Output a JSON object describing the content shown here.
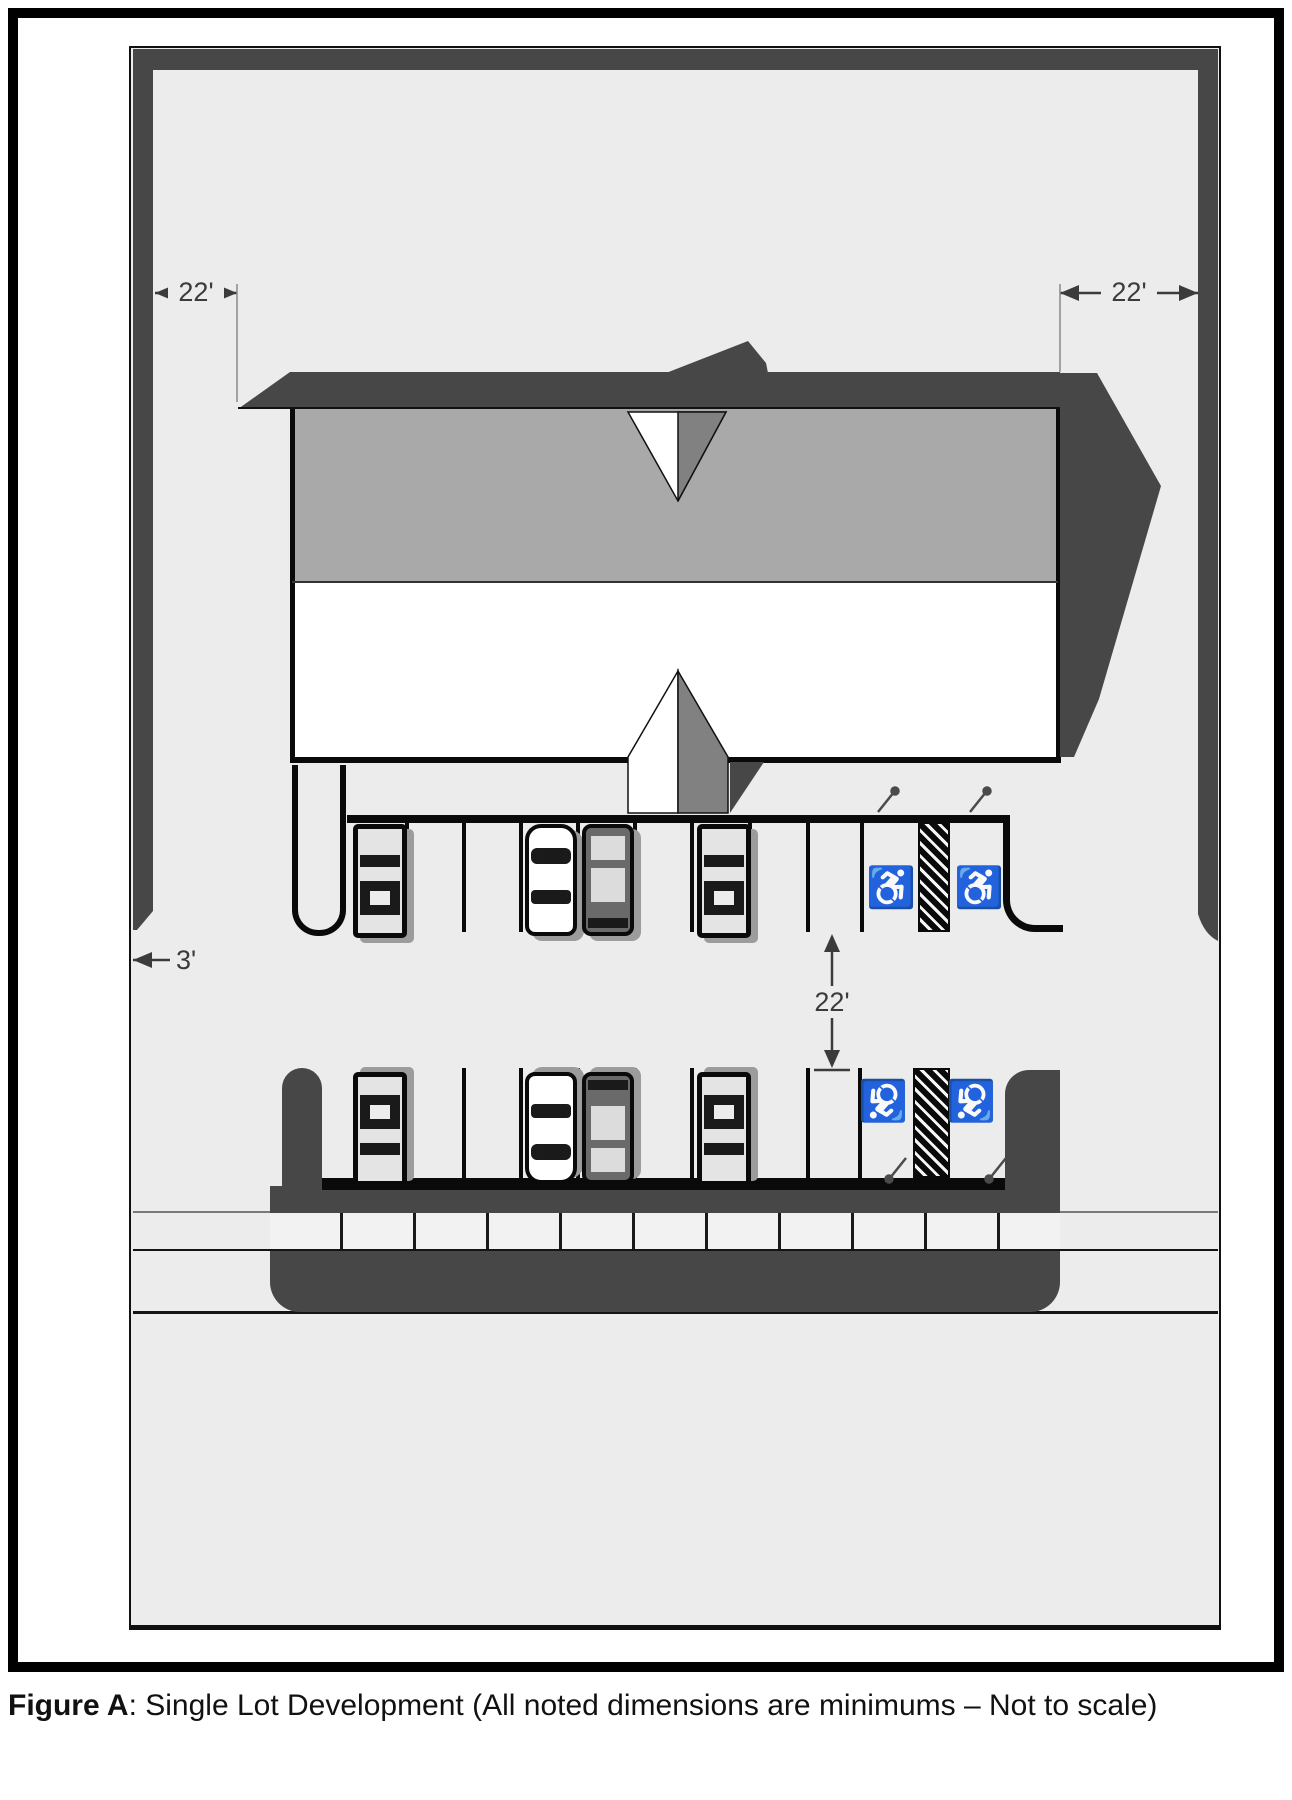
{
  "plan": {
    "dimensions": {
      "setback_left": "22'",
      "setback_right": "22'",
      "aisle_width": "22'",
      "side_strip": "3'"
    },
    "icons": {
      "wheelchair_symbol": "♿"
    },
    "colors": {
      "lot_gray": "#ececec",
      "dark_gray": "#474747",
      "roof_gray": "#a9a9a9"
    }
  },
  "caption": {
    "figure_label": "Figure A",
    "text": ": Single Lot Development (All noted dimensions are minimums – Not to scale)"
  }
}
